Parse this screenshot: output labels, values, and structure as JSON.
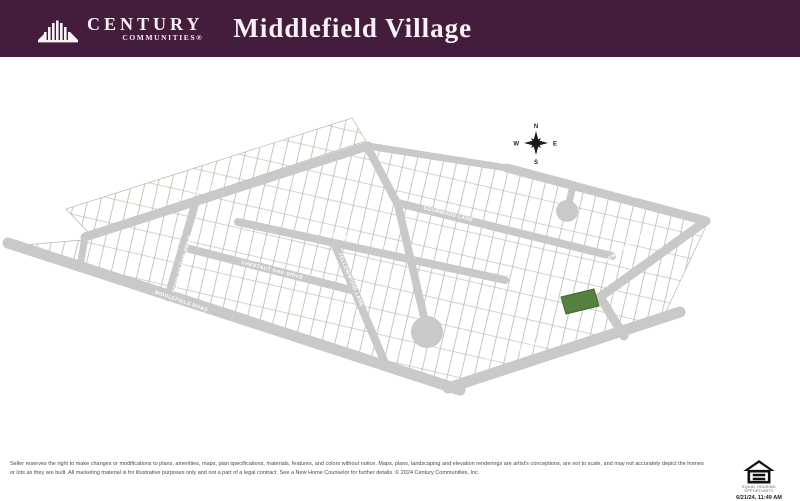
{
  "header": {
    "brand": {
      "name": "CENTURY",
      "sub": "COMMUNITIES®"
    },
    "title": "Middlefield Village"
  },
  "map": {
    "compass": {
      "n": "N",
      "s": "S",
      "e": "E",
      "w": "W"
    },
    "streets": [
      {
        "label": "PURPLE IRIS STREET"
      },
      {
        "label": "BRONZE OAK TERRACE"
      },
      {
        "label": "SOURWOOD LANE"
      },
      {
        "label": "SILVER MAPLE LANE"
      },
      {
        "label": "CHESTNUT OAK DRIVE"
      },
      {
        "label": "SCARLET OAK DRIVE"
      },
      {
        "label": "YELLOWWOOD LANE"
      },
      {
        "label": "NEW BIRCH DRIVE"
      },
      {
        "label": "MIDDLEFIELD ROAD"
      },
      {
        "label": "MIDDLEFIELD ROAD"
      }
    ],
    "road_color": "#c9c9c9",
    "highlighted_lot_color": "#55803d"
  },
  "footer": {
    "disclaimer": "Seller reserves the right to make changes or modifications to plans, amenities, maps, plan specifications, materials, features, and colors without notice. Maps, plans, landscaping and elevation renderings are artist's conceptions, are not to scale, and may not accurately depict the homes or lots as they are built. All marketing material is for illustrative purposes only and not a part of a legal contract. See a New Home Counselor for further details. © 2024 Century Communities, Inc.",
    "eho_label": "EQUAL HOUSING OPPORTUNITY",
    "timestamp": "6/21/24, 11:49 AM"
  }
}
